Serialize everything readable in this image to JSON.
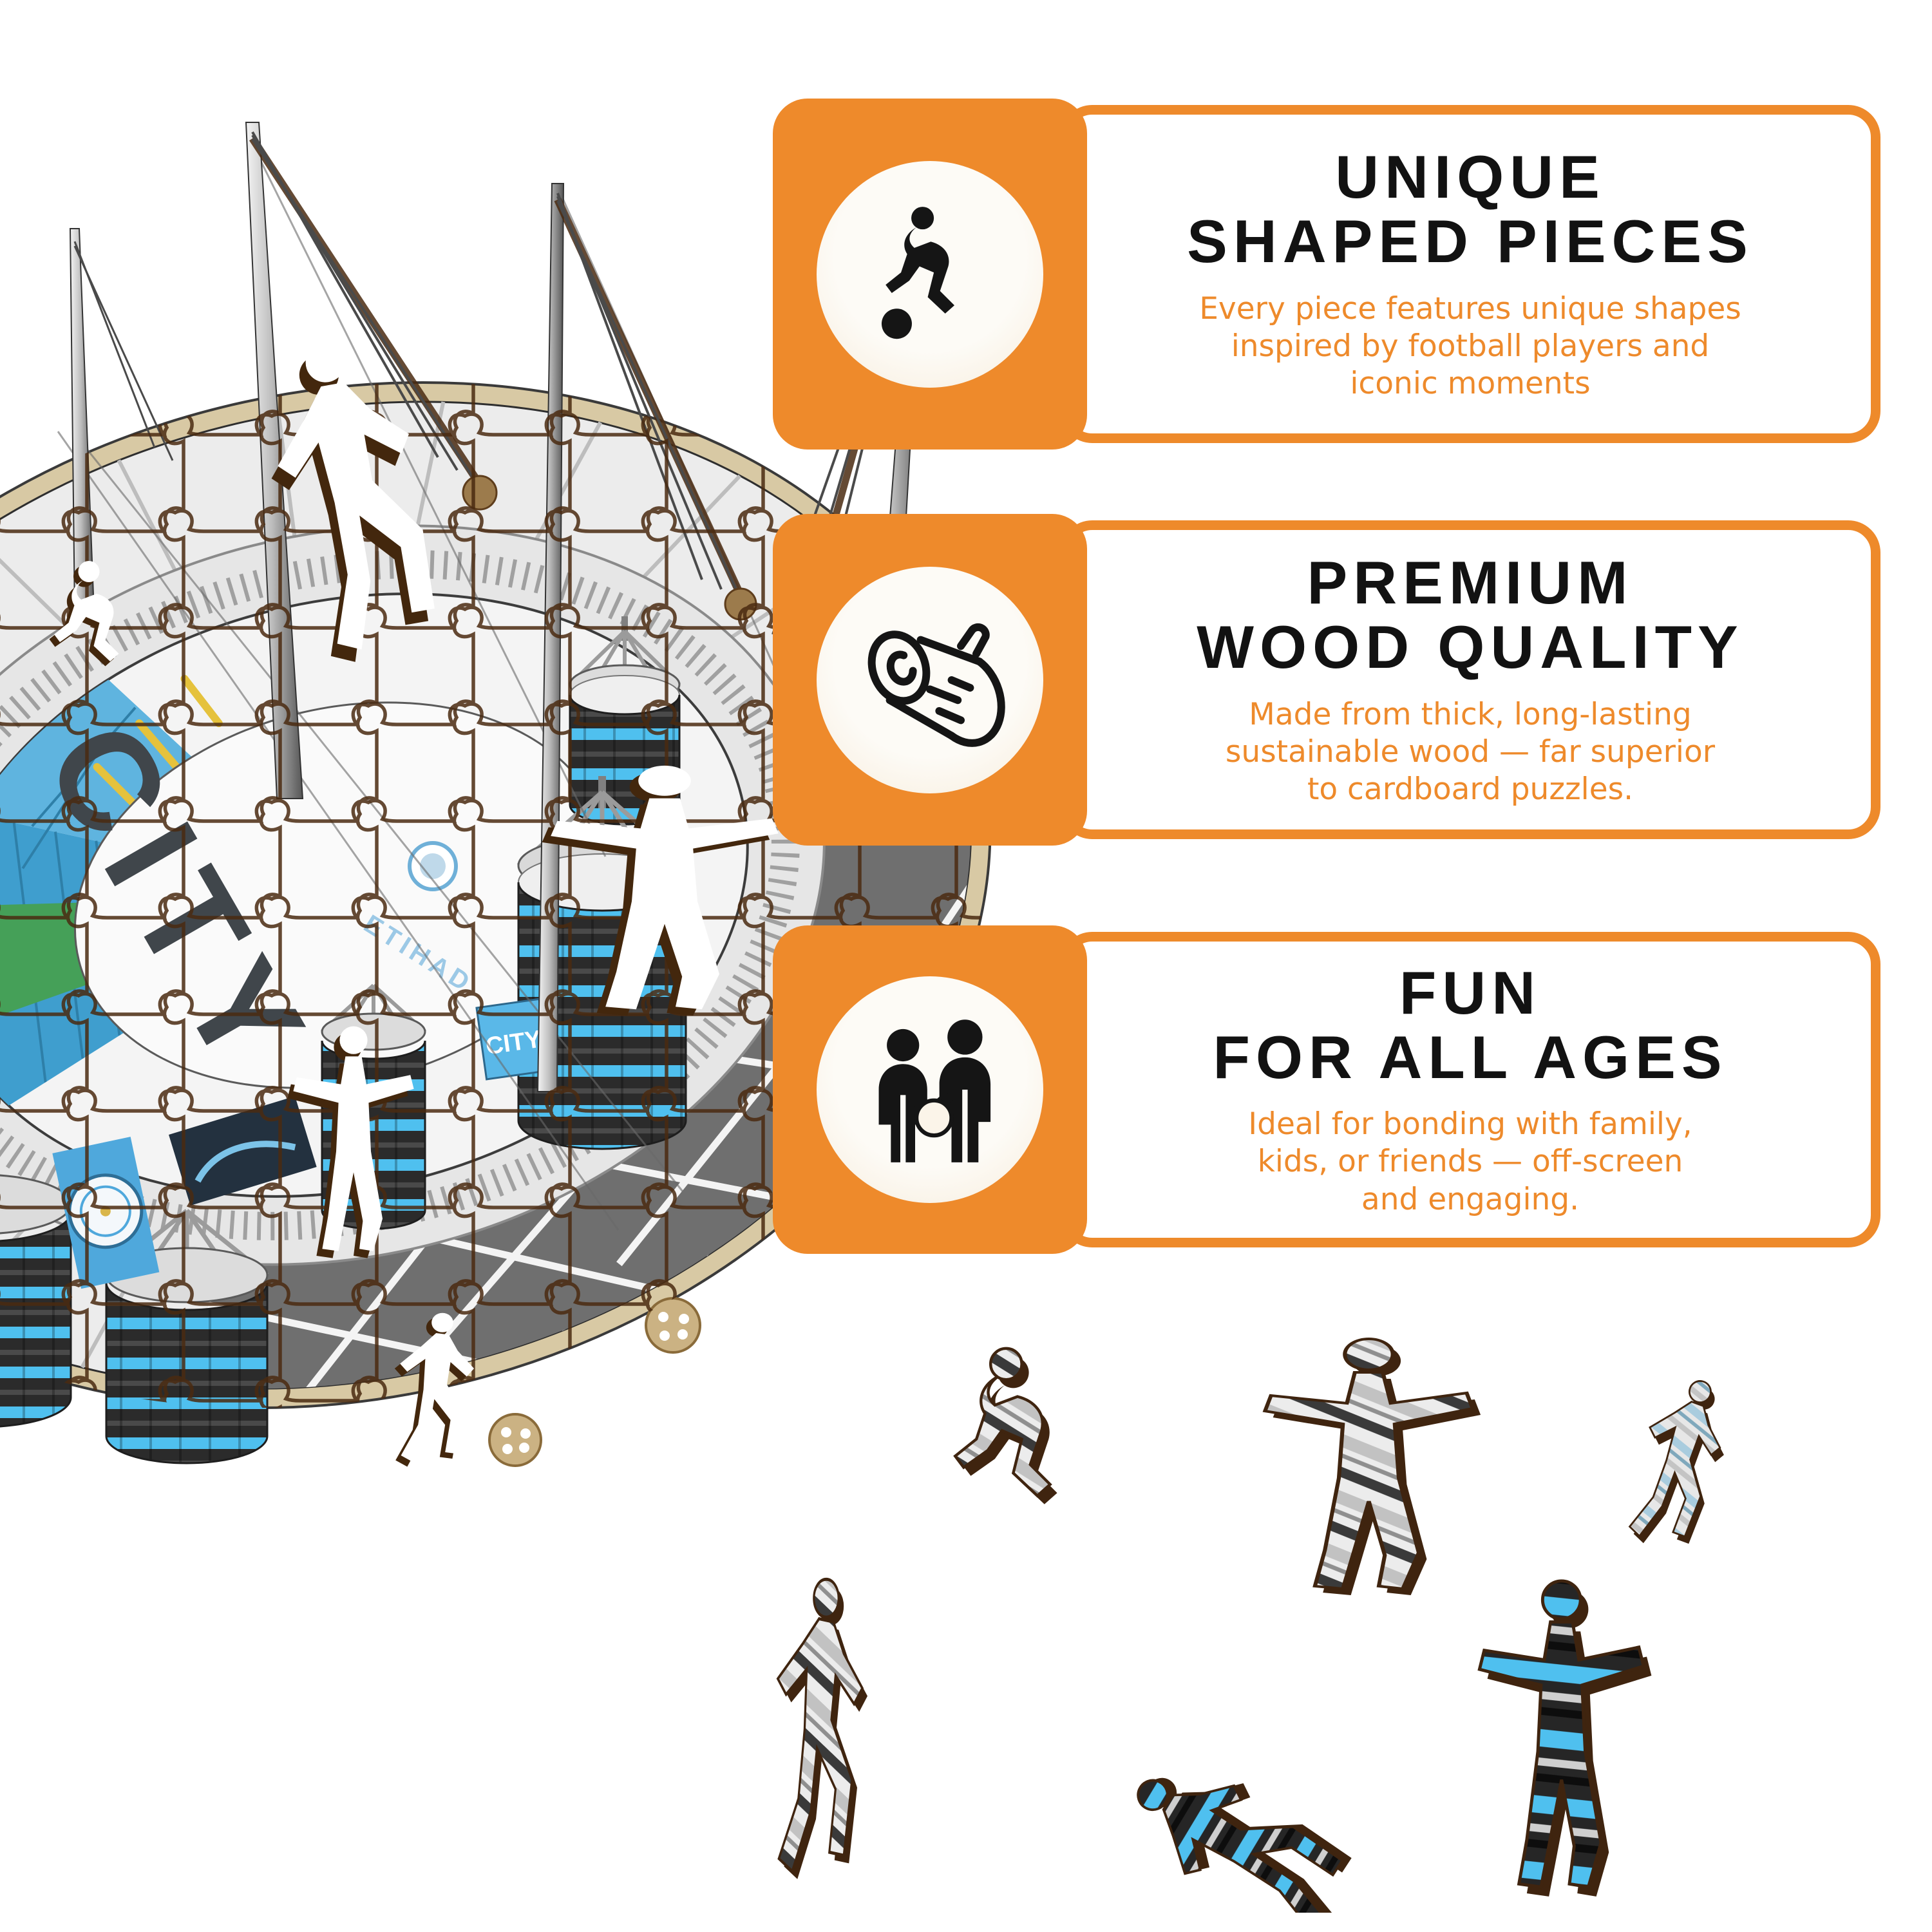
{
  "theme": {
    "accent_orange": "#EE8A2B",
    "cream": "#FBF4E9",
    "icon_black": "#151515",
    "title_black": "#121212",
    "puzzle_brown": "#4A2A10"
  },
  "features": [
    {
      "icon": "football-player-icon",
      "title_line1": "UNIQUE",
      "title_line2": "SHAPED PIECES",
      "body_line1": "Every piece features unique shapes",
      "body_line2": "inspired by football players and",
      "body_line3": "iconic moments"
    },
    {
      "icon": "wood-log-icon",
      "title_line1": "PREMIUM",
      "title_line2": "WOOD QUALITY",
      "body_line1": "Made from thick, long-lasting",
      "body_line2": "sustainable wood — far superior",
      "body_line3": "to cardboard puzzles."
    },
    {
      "icon": "family-icon",
      "title_line1": "FUN",
      "title_line2": "FOR ALL AGES",
      "body_line1": "Ideal for bonding with family,",
      "body_line2": "kids, or friends — off-screen",
      "body_line3": "and engaging."
    }
  ],
  "illustration": {
    "name": "manchester-city-etihad-stadium-wooden-puzzle",
    "roof_text": "CITY",
    "facade_text": "ETIHAD",
    "banner_text": "CITY",
    "colors": {
      "roof_gray": "#ECECEC",
      "near_roof_dark": "#6F6F6F",
      "seat_blue": "#3F9ECE",
      "seat_blue_light": "#5FB4DF",
      "stripe_blue": "#4FC0EF",
      "base_tan": "#D8C9A4",
      "pitch_green": "#45A058",
      "accent_yellow": "#E5C23C",
      "cut_shadow_brown": "#43270D"
    }
  },
  "pieces": {
    "count": 6,
    "names": [
      "crouching-player",
      "arms-out-player",
      "running-player",
      "dribbling-player",
      "diving-player",
      "kicking-player"
    ]
  }
}
